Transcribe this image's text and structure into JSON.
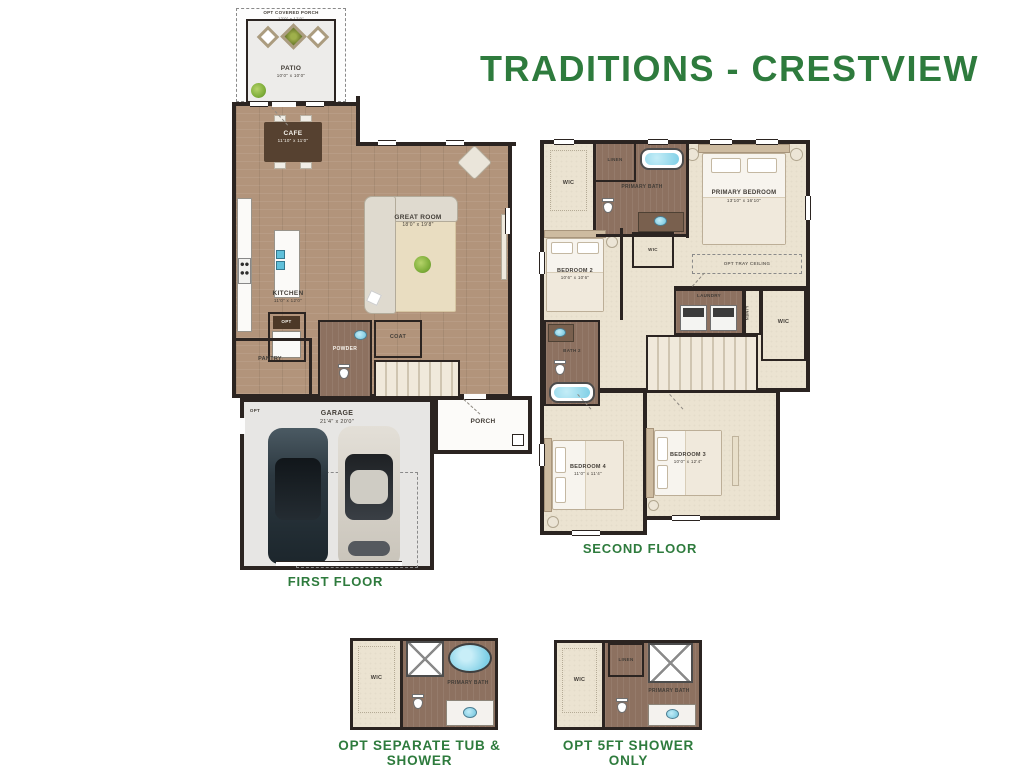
{
  "title": "TRADITIONS - CRESTVIEW",
  "accent_color": "#2e7b3d",
  "first_floor": {
    "caption": "FIRST FLOOR",
    "opt_covered_porch": {
      "label": "OPT COVERED PORCH",
      "dims": "12'0\" x 12'0\""
    },
    "patio": {
      "label": "PATIO",
      "dims": "10'0\" x 10'0\""
    },
    "cafe": {
      "label": "CAFE",
      "dims": "11'10\" x 11'0\""
    },
    "great_room": {
      "label": "GREAT ROOM",
      "dims": "18'0\" x 19'8\""
    },
    "kitchen": {
      "label": "KITCHEN",
      "dims": "11'0\" x 12'0\""
    },
    "opt_closet": {
      "label": "OPT"
    },
    "pantry": {
      "label": "PANTRY"
    },
    "powder": {
      "label": "POWDER"
    },
    "coat": {
      "label": "COAT"
    },
    "opt_entry": {
      "label": "OPT"
    },
    "garage": {
      "label": "GARAGE",
      "dims": "21'4\" x 20'0\""
    },
    "porch": {
      "label": "PORCH"
    }
  },
  "second_floor": {
    "caption": "SECOND FLOOR",
    "wic_primary": {
      "label": "WIC"
    },
    "linen_bath": {
      "label": "LINEN"
    },
    "primary_bath": {
      "label": "PRIMARY BATH"
    },
    "primary_bedroom": {
      "label": "PRIMARY BEDROOM",
      "dims": "13'10\" x 16'10\""
    },
    "bedroom_2": {
      "label": "BEDROOM 2",
      "dims": "10'6\" x 10'6\""
    },
    "wic_hall": {
      "label": "WIC"
    },
    "opt_tray_ceiling": {
      "label": "OPT TRAY CEILING"
    },
    "laundry": {
      "label": "LAUNDRY"
    },
    "linen_hall": {
      "label": "LINEN"
    },
    "wic_right": {
      "label": "WIC"
    },
    "bath_2": {
      "label": "BATH 2"
    },
    "bedroom_4": {
      "label": "BEDROOM 4",
      "dims": "11'0\" x 11'4\""
    },
    "bedroom_3": {
      "label": "BEDROOM 3",
      "dims": "10'0\" x 12'4\""
    }
  },
  "opt_tub_shower": {
    "caption": "OPT SEPARATE TUB & SHOWER",
    "wic": {
      "label": "WIC"
    },
    "primary_bath": {
      "label": "PRIMARY BATH"
    }
  },
  "opt_shower_only": {
    "caption": "OPT 5FT SHOWER ONLY",
    "wic": {
      "label": "WIC"
    },
    "linen": {
      "label": "LINEN"
    },
    "primary_bath": {
      "label": "PRIMARY BATH"
    }
  }
}
